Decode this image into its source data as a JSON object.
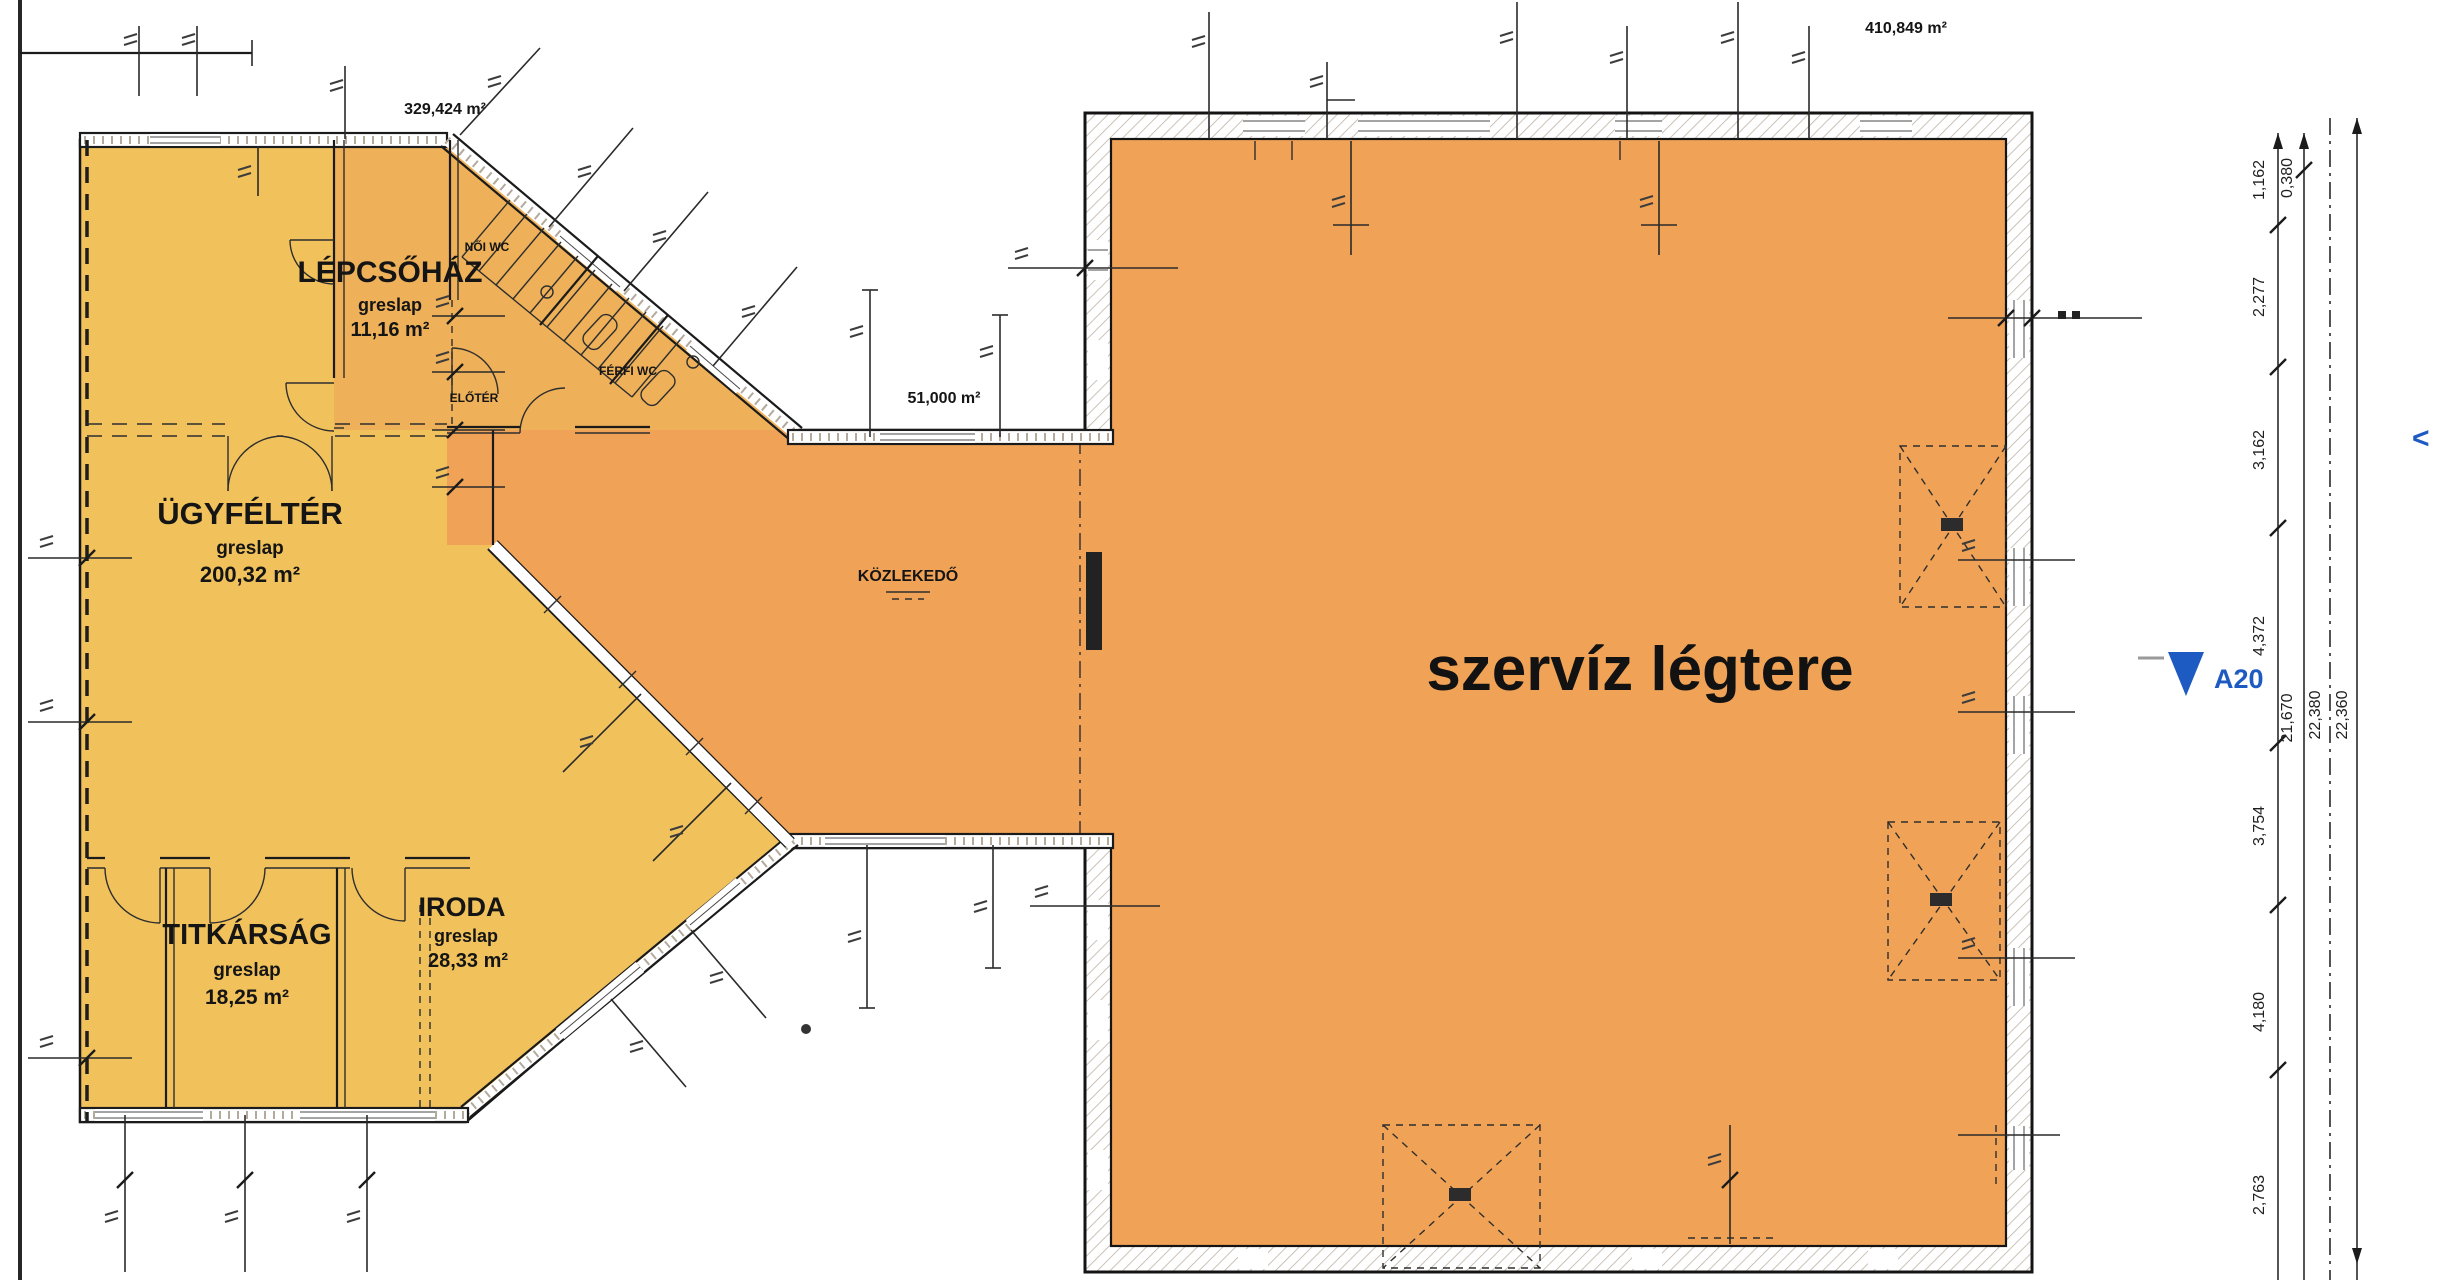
{
  "drawing": {
    "rooms": {
      "lepcsohaz": {
        "name": "LÉPCSŐHÁZ",
        "finish": "greslap",
        "area": "11,16 m²"
      },
      "ugyfelter": {
        "name": "ÜGYFÉLTÉR",
        "finish": "greslap",
        "area": "200,32 m²"
      },
      "titkarsag": {
        "name": "TITKÁRSÁG",
        "finish": "greslap",
        "area": "18,25 m²"
      },
      "iroda": {
        "name": "IRODA",
        "finish": "greslap",
        "area": "28,33 m²"
      },
      "kozlekedo": {
        "name": "KÖZLEKEDŐ"
      },
      "szerviz_legtere": {
        "name": "szervíz légtere"
      },
      "noi_wc": {
        "name": "NŐI WC"
      },
      "ferfi_wc": {
        "name": "FÉRFI WC"
      },
      "eloter": {
        "name": "ELŐTÉR"
      }
    },
    "area_labels": {
      "left_wing": "329,424 m²",
      "connector": "51,000 m²",
      "service_hall": "410,849 m²"
    },
    "section_marker": {
      "label": "A20"
    },
    "nav_chevron": "<",
    "dimensions": {
      "segments": [
        "1,162",
        "2,277",
        "3,162",
        "4,372",
        "3,754",
        "4,180",
        "2,763"
      ],
      "offset": "0,380",
      "subtotal": "21,670",
      "total_inner": "22,380",
      "total_outer": "22,360"
    },
    "colors": {
      "room_yellow": "#f1c25c",
      "hall_orange": "#f0a356",
      "stair_orange": "#eeb058",
      "marker_blue": "#1d5ac2"
    }
  }
}
